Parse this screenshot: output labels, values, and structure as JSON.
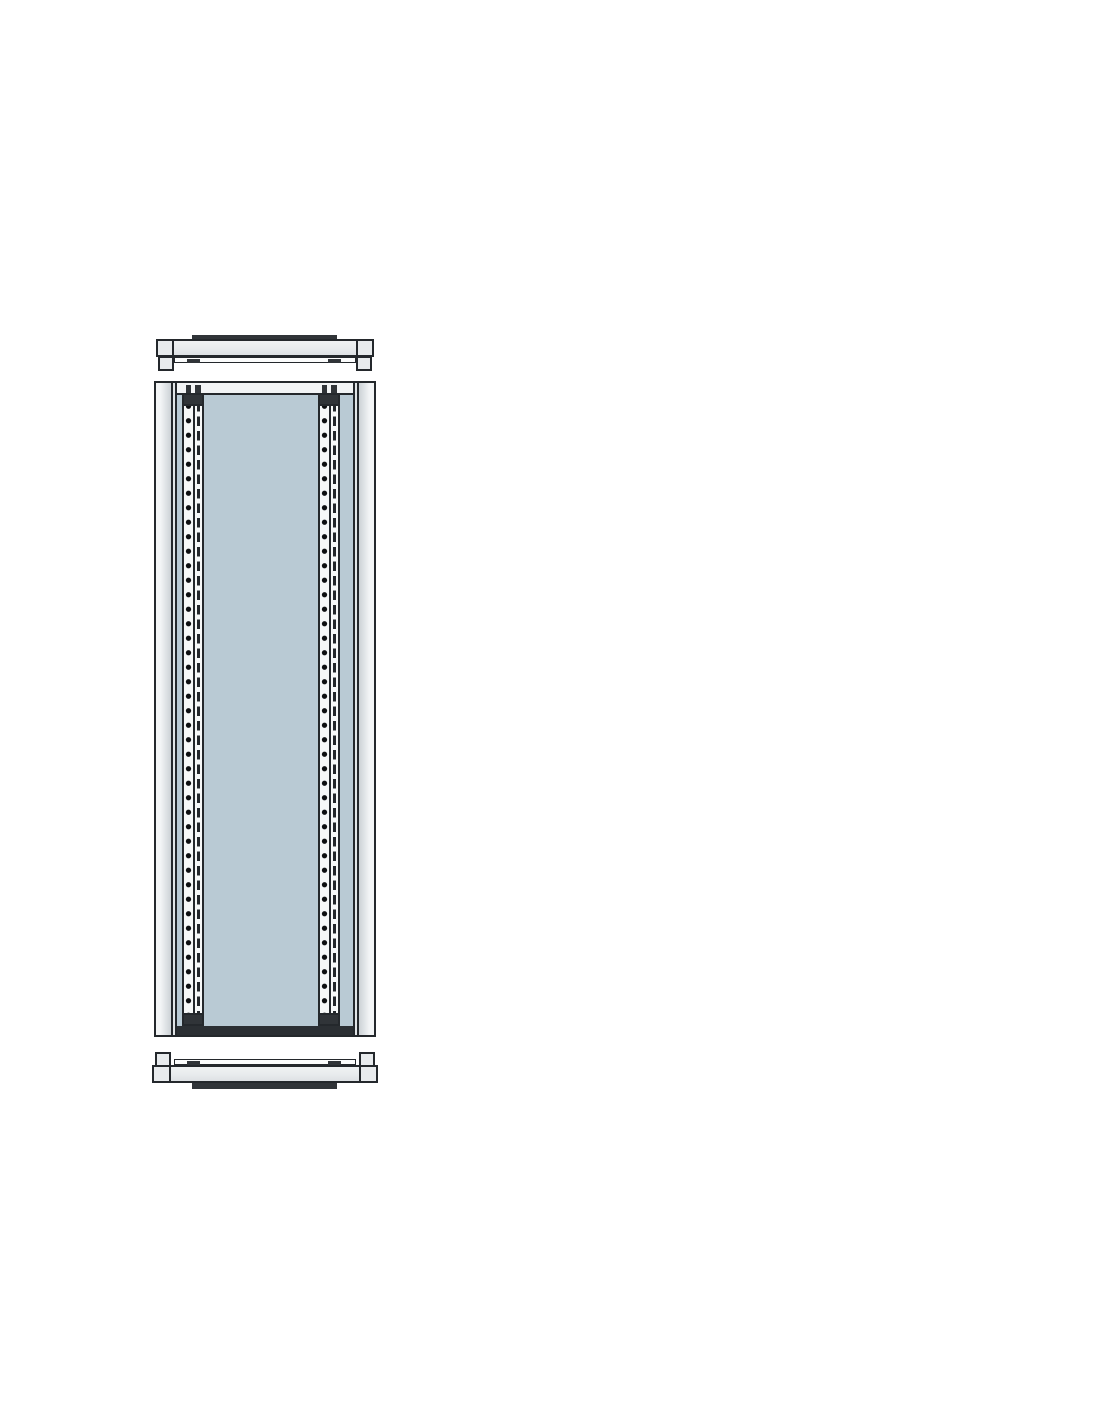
{
  "figure": {
    "kind": "technical line drawing",
    "subject": "tall enclosure frame panel with two vertical perforated mounting rails, shown between detached top and bottom horizontal cross-members with corner end blocks",
    "text_content": ""
  },
  "colors": {
    "outline": "#24282c",
    "dark_fill": "#303438",
    "metal": "#e8ebed",
    "metal_deep": "#ccd2d6",
    "panel_blue": "#b9cad4",
    "rail_white": "#f6f8f8",
    "hole_color": "#0d0f11",
    "page_bg": "#ffffff"
  },
  "pattern": {
    "hole_spacing": "14.5px",
    "slot_length": "9.5px",
    "cap_height": "13px"
  }
}
